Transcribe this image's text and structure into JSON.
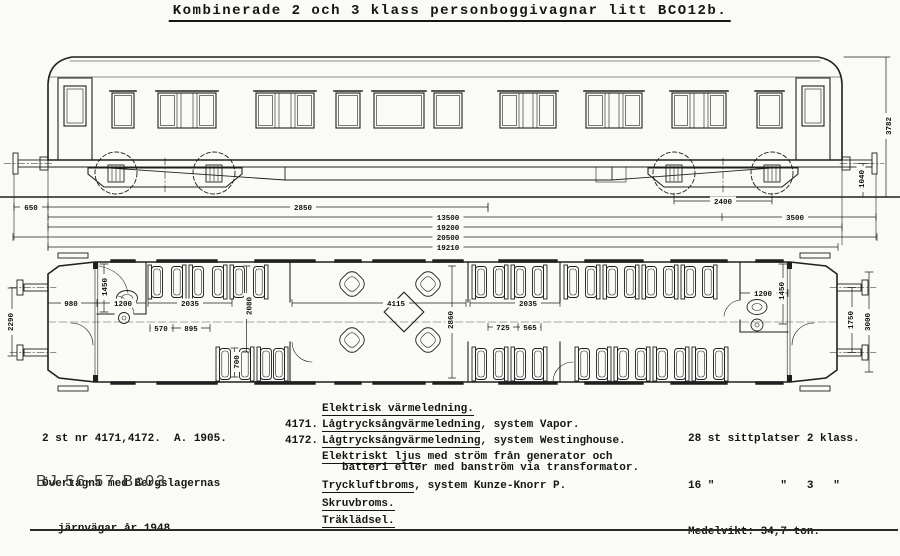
{
  "title": "Kombinerade 2 och 3 klass personboggivagnar litt BCO12b.",
  "elevation": {
    "height_total": "3782",
    "buffer_height": "1040",
    "overhang_left": "650",
    "bogie_wheelbase_left": "2850",
    "bogie_wheelbase_right": "2400",
    "overhang_right": "3500",
    "bogie_centers": "13500",
    "body_length": "19200",
    "length_over_buffers": "20500",
    "frame_length": "19210"
  },
  "plan": {
    "end_width": "2290",
    "platform_length": "980",
    "wc_left_depth": "1450",
    "wc_left_width": "1200",
    "compartment_left": "2035",
    "compartment_height": "2080",
    "seat_pitch_a": "570",
    "seat_pitch_b": "895",
    "aisle_width": "700",
    "saloon_length": "4115",
    "interior_width": "2860",
    "compartment_right": "2035",
    "seat_pitch_c": "725",
    "seat_pitch_d": "565",
    "wc_right_width": "1200",
    "wc_right_depth": "1450",
    "buffer_spacing": "1750",
    "body_width": "3000"
  },
  "notes_left": {
    "line1": "2 st nr 4171,4172.  A. 1905.",
    "line2": "Övertagna med Bergslagernas",
    "line3": "järnvägar år 1948."
  },
  "drawing_code": "BJ  56-57  Bc03",
  "notes_center": [
    {
      "num": "",
      "term": "Elektrisk värmeledning.",
      "rest": ""
    },
    {
      "num": "4171.",
      "term": "Lågtrycksångvärmeledning",
      "rest": ", system Vapor."
    },
    {
      "num": "4172.",
      "term": "Lågtrycksångvärmeledning",
      "rest": ", system Westinghouse."
    },
    {
      "num": "",
      "term": "Elektriskt ljus",
      "rest": " med ström från generator och"
    },
    {
      "num": "",
      "term": "",
      "rest": "batteri eller med banström via transformator."
    },
    {
      "num": "",
      "term": "Tryckluftbroms",
      "rest": ", system Kunze-Knorr P."
    },
    {
      "num": "",
      "term": "Skruvbroms.",
      "rest": ""
    },
    {
      "num": "",
      "term": "Träklädsel.",
      "rest": ""
    }
  ],
  "notes_right": {
    "line1": "28 st sittplatser 2 klass.",
    "line2": "16 \"          \"   3   \"",
    "line3": "Medelvikt: 34,7 ton."
  }
}
